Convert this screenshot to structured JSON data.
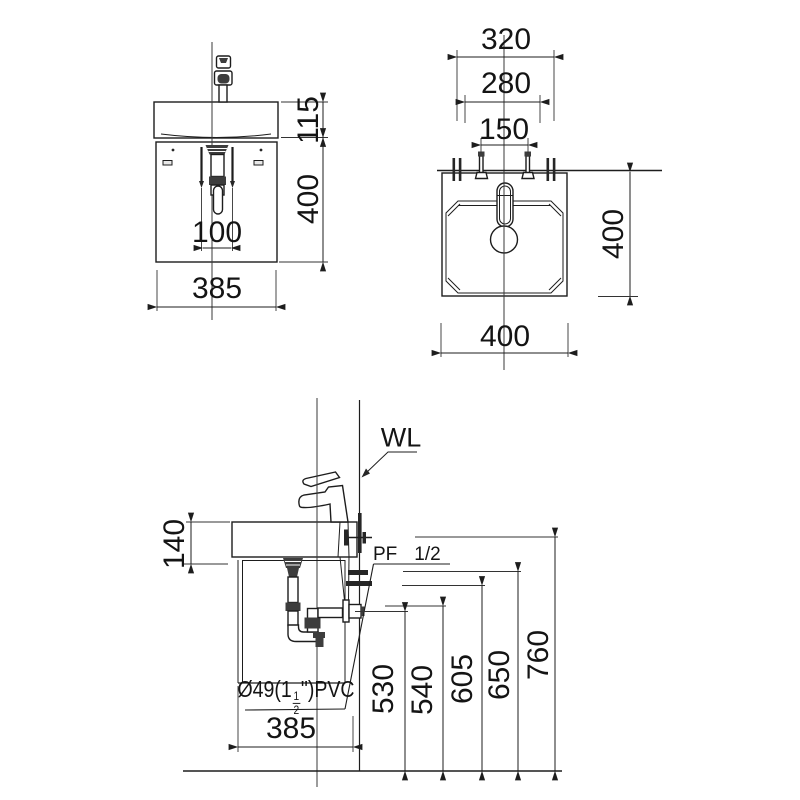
{
  "front_view": {
    "dim_sink_height": "115",
    "dim_cabinet_height": "400",
    "dim_drain_spacing": "100",
    "dim_width": "385"
  },
  "top_view": {
    "dim_bracket_span": "320",
    "dim_width_280": "280",
    "dim_hole_spacing": "150",
    "dim_depth": "400",
    "dim_width": "400"
  },
  "side_view": {
    "wall_label": "WL",
    "supply_label": "PF",
    "supply_size": "1/2",
    "pipe_prefix": "Ø49(1",
    "pipe_frac_num": "1",
    "pipe_frac_den": "2",
    "pipe_suffix": "\")PVC",
    "dim_apron_height": "140",
    "dim_depth": "385",
    "dim_530": "530",
    "dim_540": "540",
    "dim_605": "605",
    "dim_650": "650",
    "dim_760": "760"
  },
  "colors": {
    "line": "#1d1d1d",
    "background": "#ffffff"
  }
}
